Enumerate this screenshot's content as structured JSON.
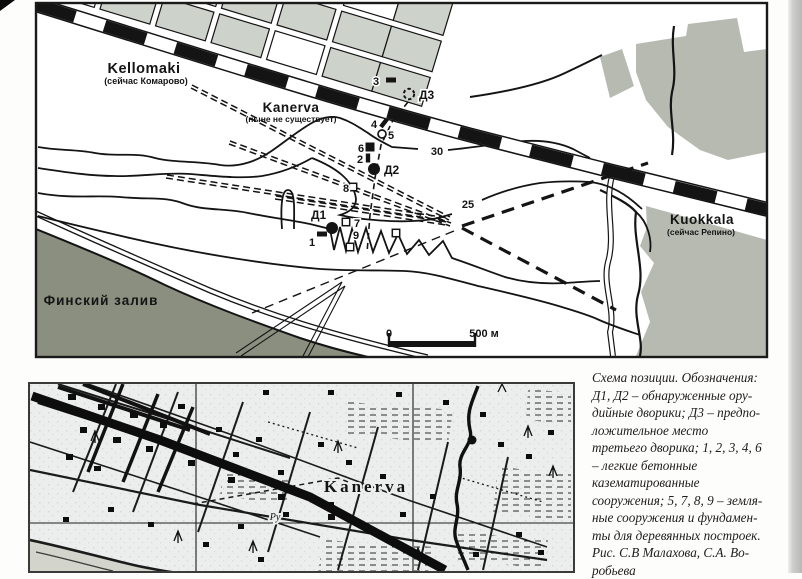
{
  "colors": {
    "ink": "#141414",
    "sea": "#8b8f80",
    "block": "#cdd2ca",
    "block_alt": "#d2cec0",
    "forest": "#b6bab1",
    "paper": "#ffffff",
    "scan_paper": "#eceded",
    "frame": "#1a1a1a"
  },
  "top_map": {
    "labels": [
      {
        "id": "kellomaki",
        "text": "Kellomaki",
        "x": 144,
        "y": 73,
        "size": 14.5,
        "weight": 700,
        "ls": 0.5
      },
      {
        "id": "kellomaki-sub",
        "text": "(сейчас Комарово)",
        "x": 146,
        "y": 84,
        "size": 9,
        "weight": 700
      },
      {
        "id": "kanerva",
        "text": "Kanerva",
        "x": 291,
        "y": 112,
        "size": 13.5,
        "weight": 700,
        "ls": 0.5
      },
      {
        "id": "kanerva-sub",
        "text": "(ныне не существует)",
        "x": 291,
        "y": 122,
        "size": 8.5,
        "weight": 700
      },
      {
        "id": "kuokkala",
        "text": "Kuokkala",
        "x": 702,
        "y": 224,
        "size": 13.5,
        "weight": 700,
        "ls": 0.5
      },
      {
        "id": "kuokkala-sub",
        "text": "(сейчас Репино)",
        "x": 701,
        "y": 235,
        "size": 8.5,
        "weight": 700
      },
      {
        "id": "gulf-of-finland",
        "text": "Финский залив",
        "x": 101,
        "y": 305,
        "size": 13.5,
        "weight": 700,
        "ls": 1
      },
      {
        "id": "contour-30",
        "text": "30",
        "x": 437,
        "y": 155,
        "size": 11,
        "weight": 600,
        "halo": true
      },
      {
        "id": "contour-25",
        "text": "25",
        "x": 468,
        "y": 208,
        "size": 11,
        "weight": 600,
        "halo": true
      },
      {
        "id": "scale-zero",
        "text": "0",
        "x": 389,
        "y": 337,
        "size": 11,
        "weight": 700
      },
      {
        "id": "scale-500",
        "text": "500 м",
        "x": 484,
        "y": 337,
        "size": 11,
        "weight": 700
      }
    ],
    "markers": [
      {
        "id": "3",
        "type": "rect-black",
        "x": 391,
        "y": 80,
        "label": "3",
        "lx": 373,
        "ly": 85
      },
      {
        "id": "D3",
        "type": "circle-dashed",
        "x": 409,
        "y": 94,
        "label": "Д3",
        "lx": 419,
        "ly": 99,
        "lsize": 12
      },
      {
        "id": "4",
        "type": "diamond-black",
        "x": 384,
        "y": 123,
        "label": "4",
        "lx": 371,
        "ly": 128
      },
      {
        "id": "5",
        "type": "circle-white",
        "x": 382,
        "y": 134,
        "label": "5",
        "lx": 388,
        "ly": 139
      },
      {
        "id": "6",
        "type": "square-black",
        "x": 370,
        "y": 147,
        "label": "6",
        "lx": 358,
        "ly": 152
      },
      {
        "id": "2",
        "type": "rect-black-v",
        "x": 368,
        "y": 158,
        "label": "2",
        "lx": 357,
        "ly": 163
      },
      {
        "id": "D2",
        "type": "circle-black",
        "x": 374,
        "y": 169,
        "label": "Д2",
        "lx": 384,
        "ly": 174,
        "lsize": 12
      },
      {
        "id": "8",
        "type": "square-white",
        "x": 353,
        "y": 187,
        "label": "8",
        "lx": 343,
        "ly": 192
      },
      {
        "id": "D1",
        "type": "circle-black",
        "x": 332,
        "y": 228,
        "label": "Д1",
        "lx": 311,
        "ly": 219,
        "lsize": 12
      },
      {
        "id": "7",
        "type": "square-white",
        "x": 346,
        "y": 222,
        "label": "7",
        "lx": 354,
        "ly": 227
      },
      {
        "id": "1",
        "type": "rect-black",
        "x": 322,
        "y": 234,
        "label": "1",
        "lx": 309,
        "ly": 246
      },
      {
        "id": "9",
        "type": "square-white",
        "x": 350,
        "y": 247,
        "label": "9",
        "lx": 353,
        "ly": 239
      },
      {
        "id": "sq-extra",
        "type": "square-white",
        "x": 396,
        "y": 233,
        "label": "",
        "lx": 0,
        "ly": 0
      }
    ]
  },
  "bottom_map": {
    "labels": [
      {
        "id": "kanerva-old-map",
        "text": "Kanerva",
        "x": 338,
        "y": 110,
        "size": 17,
        "weight": 700,
        "ls": 3,
        "serif": true,
        "halo": true
      },
      {
        "id": "stream-label",
        "text": "Ру",
        "x": 247,
        "y": 138,
        "size": 10,
        "weight": 400,
        "serif": true,
        "italic": true,
        "halo": true
      }
    ]
  },
  "caption": {
    "lines": [
      "Схема позиции. Обозначения:",
      "Д1, Д2 – обнаруженные ору-",
      "дийные дворики; Д3 – предпо-",
      "ложительное место",
      "третьего дворика; 1, 2, 3, 4, 6",
      "– легкие бетонные",
      "казематированные",
      "сооружения; 5, 7, 8, 9 – земля-",
      "ные сооружения и фундамен-",
      "ты для деревянных построек.",
      "Рис. С.В Малахова, С.А. Во-",
      "робьева"
    ]
  }
}
